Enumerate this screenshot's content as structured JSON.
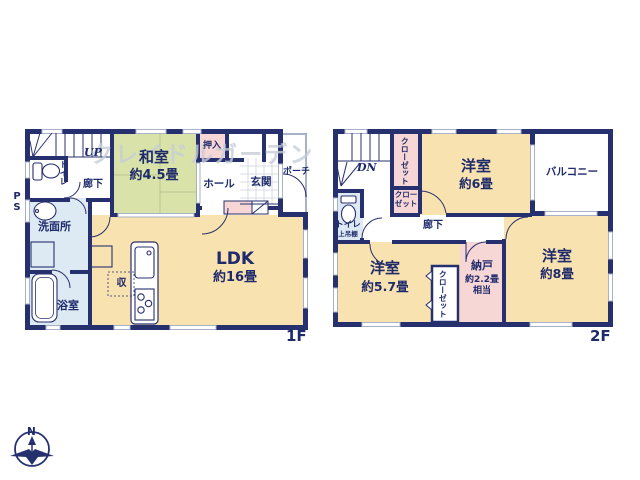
{
  "watermark": "クレイドルガーデン",
  "compass": {
    "north_label": "N"
  },
  "colors": {
    "wall_navy": "#27306e",
    "text_navy": "#1f2a6b",
    "room_cream": "#f8e2b0",
    "tatami_green": "#d9e3a9",
    "closet_pink": "#f7d6d6",
    "water_blue": "#ddeaf4",
    "window_gray": "#a8b2c6",
    "watermark_gray": "#c8cdd7"
  },
  "floor1": {
    "floor_label": "1F",
    "stairs_label": "UP",
    "pipe_space_label": "PS",
    "corridor_label": "廊下",
    "toilet_label": "トイレ",
    "washroom_label": "洗面所",
    "bathroom_label": "浴室",
    "washitsu_name": "和室",
    "washitsu_size": "約4.5畳",
    "oshiire_label": "押入",
    "hall_label": "ホール",
    "genkan_label": "玄関",
    "porch_label": "ポーチ",
    "ldk_name": "LDK",
    "ldk_size": "約16畳",
    "storage_label": "収"
  },
  "floor2": {
    "floor_label": "2F",
    "stairs_label": "DN",
    "corridor_label": "廊下",
    "toilet_label": "トイレ",
    "toilet_note": "上吊棚",
    "closet_tall_label": "クローゼット",
    "closet_small_label": "クローゼット",
    "bedroom6_name": "洋室",
    "bedroom6_size": "約6畳",
    "balcony_label": "バルコニー",
    "bedroom57_name": "洋室",
    "bedroom57_size": "約5.7畳",
    "closet57_label": "クローゼット",
    "nando_name": "納戸",
    "nando_size": "約2.2畳",
    "nando_size2": "相当",
    "bedroom8_name": "洋室",
    "bedroom8_size": "約8畳"
  }
}
